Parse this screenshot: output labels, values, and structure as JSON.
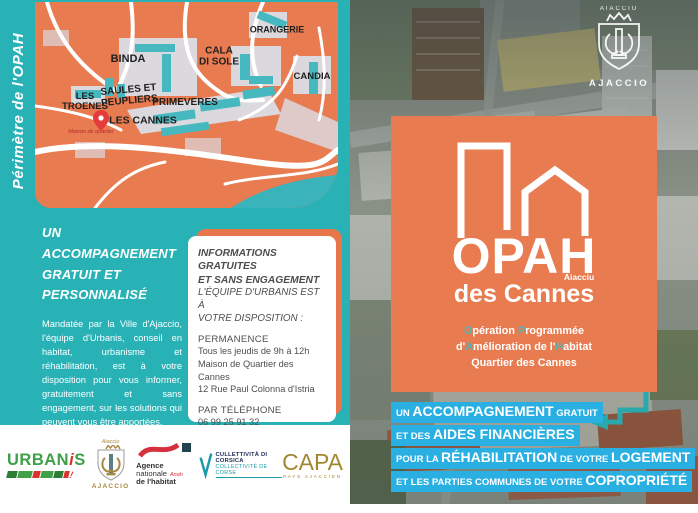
{
  "brochure": {
    "left": {
      "map": {
        "vertical_label": "Périmètre de l'OPAH",
        "labels": {
          "orangerie": "ORANGERIE",
          "binda": "BINDA",
          "cala1": "CALA",
          "cala2": "DI SOLE",
          "candia": "CANDIA",
          "troenes1": "LES",
          "troenes2": "TROENES",
          "saules1": "SAULES ET",
          "saules2": "PEUPLIERS",
          "primeveres": "PRIMEVERES",
          "cannes": "LES CANNES",
          "poi": "Maison de quartier"
        }
      },
      "intro": {
        "heading1": "UN ACCOMPAGNEMENT",
        "heading2": "GRATUIT ET PERSONNALISÉ",
        "para1": "Mandatée par la Ville d'Ajaccio, l'équipe d'Urbanis, conseil en habitat, urbanisme et réhabilitation, est à votre disposition pour vous informer, gratuitement et sans engagement, sur les solutions qui peuvent vous être apportées.",
        "para2": "Pour simplifier et faciliter vos démarches, des conseillers vous aideront à définir vos besoins et vous proposeront un plan de financement adapté à votre projet."
      },
      "card": {
        "heading1a": "INFORMATIONS GRATUITES",
        "heading1b": "ET SANS ENGAGEMENT",
        "heading2a": "L'ÉQUIPE D'URBANIS EST À",
        "heading2b": "VOTRE DISPOSITION :",
        "permanence_label": "PERMANENCE",
        "permanence1": "Tous les jeudis de 9h à 12h",
        "permanence2": "Maison de Quartier des Cannes",
        "permanence3": "12 Rue Paul Colonna d'Istria",
        "phone_label": "PAR TÉLÉPHONE",
        "phone": "06 99 25 91 32",
        "mail_label": "PAR MAIL",
        "mail": "opahdescannes@urbanis.fr"
      },
      "logos": {
        "urbanis_part1": "URBAN",
        "urbanis_i": "i",
        "urbanis_part2": "S",
        "urbanis_bang": "!",
        "ajaccio_top": "Aiacciu",
        "ajaccio_name": "AJACCIO",
        "anah1": "Agence",
        "anah2": "nationale",
        "anah3": "de l'habitat",
        "anah_mark": "Anah",
        "corsica1": "CULLETTIVITÀ DI CORSICA",
        "corsica2": "COLLECTIVITÉ DE CORSE",
        "capa": "CAPA",
        "capa_sub": "PAYS AJACCIEN"
      }
    },
    "right": {
      "crest": {
        "top": "AIACCIU",
        "name": "AJACCIO"
      },
      "logo": {
        "title": "OPAH",
        "subtitle": "des Cannes",
        "subtitle_sup": "Aiacciu",
        "tagline": {
          "o": "O",
          "operation": "pération ",
          "p": "P",
          "programmee": "rogrammée",
          "d": "d'",
          "a": "A",
          "amelioration": "mélioration de l'",
          "h": "H",
          "habitat": "abitat",
          "line3": "Quartier des Cannes"
        }
      },
      "banner": {
        "l1a": "UN ",
        "l1b": "ACCOMPAGNEMENT",
        "l1c": " GRATUIT",
        "l2a": "ET DES ",
        "l2b": "AIDES FINANCIÈRES",
        "l3a": "POUR LA ",
        "l3b": "RÉHABILITATION",
        "l3c": " DE VOTRE ",
        "l3d": "LOGEMENT",
        "l4a": "ET LES PARTIES COMMUNES DE VOTRE ",
        "l4b": "COPROPRIÉTÉ"
      }
    },
    "colors": {
      "teal_background": "#29b2b6",
      "orange": "#e87b50",
      "cyan_highlight": "#29afe2",
      "map_building_teal": "#45b9bf",
      "urbanis_green": "#3fa047",
      "urbanis_red": "#d6342c",
      "anah_red": "#d62f3e",
      "corsica_teal": "#1b9aa8",
      "capa_gold": "#a3872f",
      "ajaccio_gold": "#a8893f"
    }
  }
}
